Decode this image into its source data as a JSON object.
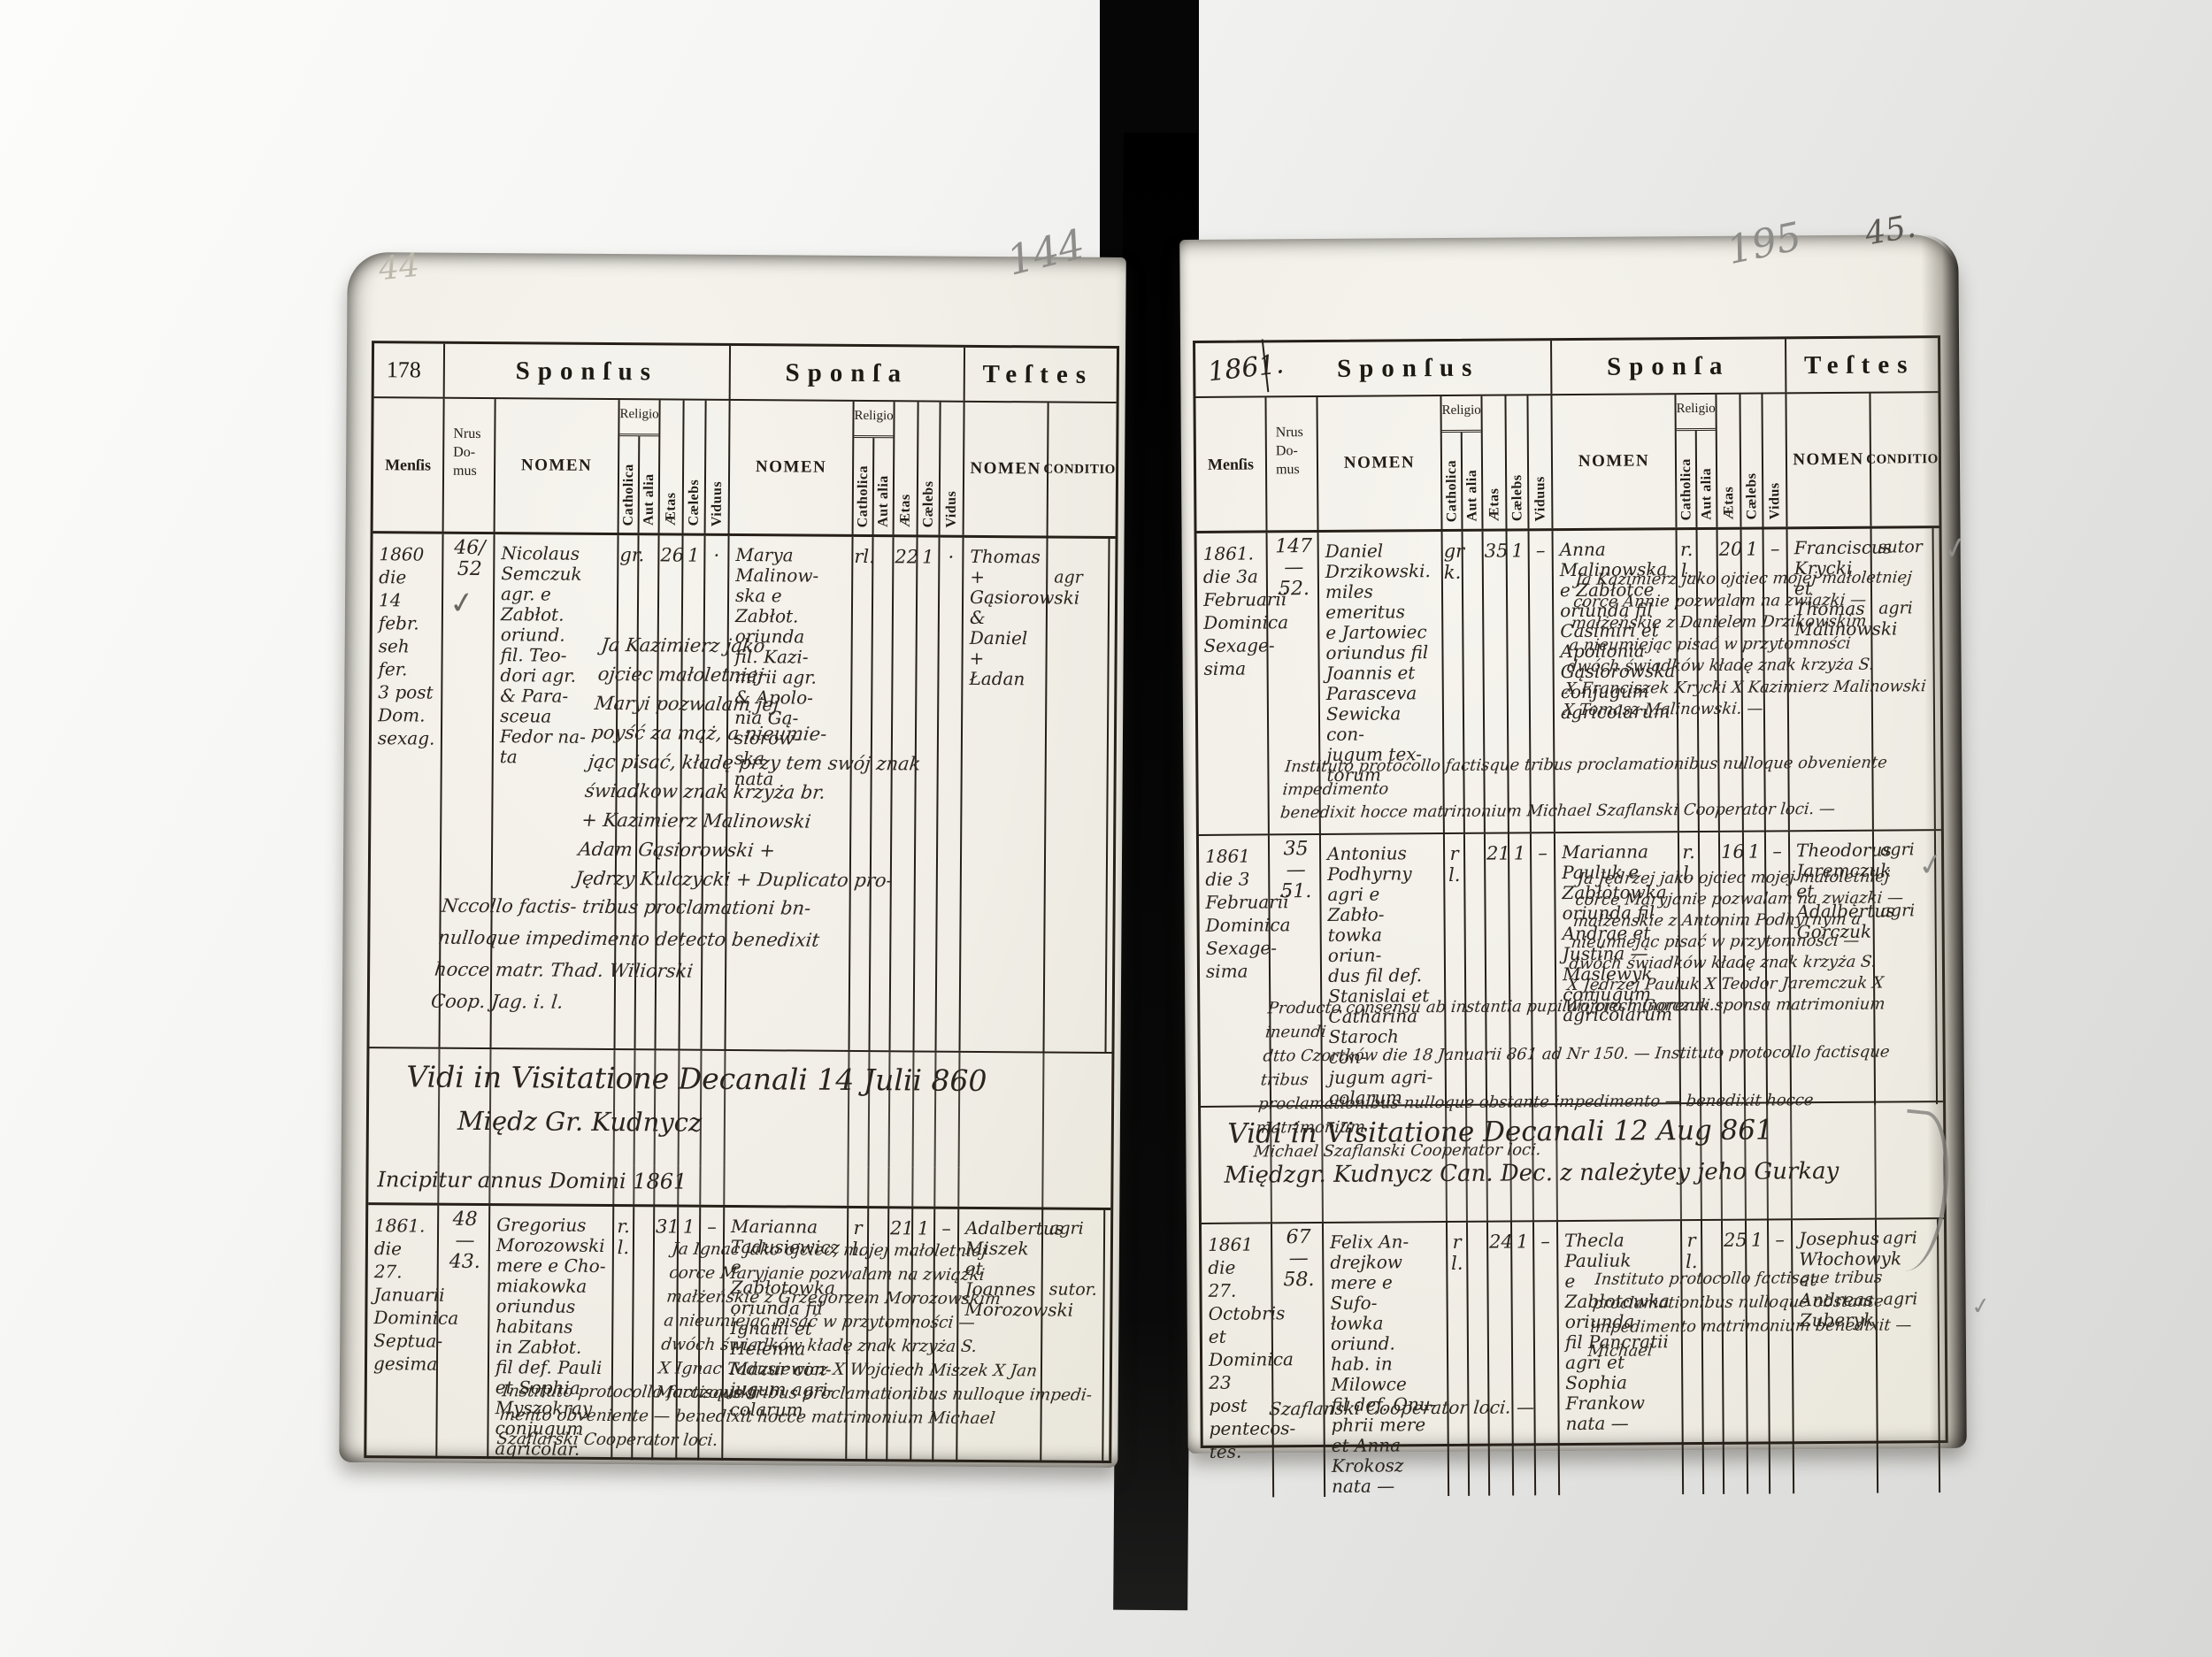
{
  "headers": {
    "sponsus": "Sponſus",
    "sponsa": "Sponſa",
    "testes": "Teſtes",
    "mensis": "Menſis",
    "nrus": "Nrus\nDo-\nmus",
    "nomen": "NOMEN",
    "religio": "Religio",
    "catholica": "Catholica",
    "aut_alia": "Aut alia",
    "aetas": "Ætas",
    "caelebs": "Cælebs",
    "viduus": "Viduus",
    "vidus": "Vidus",
    "conditio": "CONDITIO"
  },
  "marks": {
    "top_left_faint": "44",
    "left_page_pencil": "144",
    "right_page_pencil": "195",
    "right_page_ink": "45.",
    "check": "✓"
  },
  "left_page": {
    "page_number": "178",
    "visitation_line1": "Vidi in Visitatione Decanali 14 Julii 860",
    "visitation_line2": "Międz Gr. Kudnycz",
    "incipitur": "Incipitur annus Domini 1861",
    "entries": [
      {
        "mensis": "1860\ndie\n14 febr.\nseh fer.\n3 post\nDom.\nsexag.",
        "nrus": "46/\n52",
        "sp_nomen": "Nicolaus\nSemczuk\nagr. e\nZabłot.\noriund.\nfil. Teo-\ndori agr.\n& Para-\nsceua\nFedor na-\nta",
        "sp_rel": "gr.",
        "sp_aetas": "26",
        "sp_cael": "1",
        "sp_vid": "·",
        "sa_nomen": "Marya\nMalinow-\nska e\nZabłot.\noriunda\nfil. Kazi-\nmirii agr.\n& Apolo-\nnia Gą-\nsiorow-\nska\nnata",
        "sa_rel": "rl.",
        "sa_aetas": "22",
        "sa_cael": "1",
        "sa_vid": "·",
        "t_nomen": "Thomas +\nGąsiorowski\n&\nDaniel +\nŁadan",
        "t_cond": "\nagr",
        "note_pl": "Ja Kazimierz jako\nojciec małoletniej\nMaryi pozwalam jej\npoyść za mąż, a nieumie-\njąc pisać, kładę przy tem swój znak\nświadkow znak krzyża br.\n+ Kazimierz Malinowski\nAdam Gąsiorowski +\nJędrzy Kulczycki +      Duplicato pro-",
        "note_la": "Nccollo factis- tribus proclamationi bn-\nnulloque impedimento detecto benedixit\nhocce matr.      Thad. Wiliorski\nCoop. Jag. i. l."
      },
      {
        "mensis": "1861.\ndie 27.\nJanuarii\nDominica\nSeptua-\ngesima",
        "nrus": "48\n—\n43.",
        "sp_nomen": "Gregorius\nMorozowski\nmere e Cho-\nmiakowka\noriundus\nhabitans\nin Zabłot.\nfil def. Pauli\net Sophia\nMyszokray\nconjugum\nagricolar.",
        "sp_rel": "r. l.",
        "sp_aetas": "31",
        "sp_cael": "1",
        "sp_vid": "–",
        "sa_nomen": "Marianna\nTadusiewicz\ne Zabłotowka\noriunda fil\nIgnatii et\nHelenna\nMazur con-\njugum agri-\ncolarum",
        "sa_rel": "r l.",
        "sa_aetas": "21",
        "sa_cael": "1",
        "sa_vid": "–",
        "t_nomen": "Adalbertus\nMiszek\net\nJoannes\nMorozowski",
        "t_cond": "agri\n\n\nsutor.",
        "note_pl": "Ja Ignac jako ojciec, mojej małoletniej\ncorce Maryjanie pozwalam na związki\nmałżeńskie z Grzegorzem Morozowskim\na nieumiejąc pisać w przytomności —\ndwóch świadków kładę znak krzyża S.\nX Ignac Tadusiewicz X Wojciech Miszek X Jan Morozowski",
        "note_la": "Instituto protocollo factisque tribus proclamationibus nulloque impedi-\nmento obveniente — benedixit hocce matrimonium Michael\nSzaflarski Cooperator loci."
      }
    ]
  },
  "right_page": {
    "corner_year": "1861.",
    "visitation_line1": "Vidi in Visitatione Decanali 12 Aug 861",
    "visitation_line2": "Międzgr. Kudnycz Can. Dec. z należytey jeho Gurkay",
    "entries": [
      {
        "mensis": "1861.\ndie 3a\nFebruarii\nDominica\nSexage-\nsima",
        "nrus": "147\n—\n52.",
        "sp_nomen": "Daniel\nDrzikowski.\nmiles emeritus\ne Jartowiec\noriundus fil\nJoannis et\nParasceva\nSewicka con-\njugum tex-\ntorum",
        "sp_rel": "gr k.",
        "sp_aetas": "35",
        "sp_cael": "1",
        "sp_vid": "–",
        "sa_nomen": "Anna\nMalinowska\ne Zabłotce\noriunda fil\nCasimiri et\nApollonia\nGąsiorowska\nconjugum\nagricolarum",
        "sa_rel": "r. l.",
        "sa_aetas": "20",
        "sa_cael": "1",
        "sa_vid": "–",
        "t_nomen": "Franciscus\nKrycki\net\nThomas\nMalinowski",
        "t_cond": "sutor\n\n\nagri",
        "note_pl": "Ja Kazimierz jako ojciec mojej małoletniej\ncorce Annie pozwalam na związki —\nmałżeńskie z Danielem Drzikowskim\na nieumiejąc pisać w przytomności\ndwóch świadków kładę znak krzyża S.\nX Franciszek Krycki X Kazimierz Malinowski\nX Tomasz Malinowski. —",
        "note_la": "Instituto protocollo factisque tribus proclamationibus nulloque obveniente impedimento\nbenedixit hocce matrimonium      Michael Szaflanski Cooperator loci. —"
      },
      {
        "mensis": "1861\ndie 3\nFebruarii\nDominica\nSexage-\nsima",
        "nrus": "35\n—\n51.",
        "sp_nomen": "Antonius\nPodhyrny\nagri e Zabło-\ntowka oriun-\ndus fil def.\nStanislai et\nCatharina\nStaroch con-\njugum agri-\ncolarum",
        "sp_rel": "r l.",
        "sp_aetas": "21",
        "sp_cael": "1",
        "sp_vid": "–",
        "sa_nomen": "Marianna\nPauluk e\nZabłotowka\noriunda fil\nAndrae et\nJustina —\nMaslewyk\nconjugum\nagricolarum",
        "sa_rel": "r. l.",
        "sa_aetas": "16",
        "sa_cael": "1",
        "sa_vid": "–",
        "t_nomen": "Theodorus\nJaremczuk\net\nAdalbertus\nGorczuk",
        "t_cond": "agri\n\n\nagri",
        "note_pl": "Ja Jędrzej jako ojciec mojej małoletniej\ncorce Maryjanie pozwalam na związki —\nmałżeńskie z Antonim Podhyrnym a\nnieumiejąc pisać w przytomności —\ndwóch świadków kładę znak krzyża S.\nX Jędrzej Pauluk X Teodor Jaremczuk X Wojciech Gorczuk.",
        "note_la": "Producto consensu ab instantia pupilari pro minorenni sponsa matrimonium ineundi\ndtto Czortków die 18 Januarii 861 ad Nr 150. —      Instituto protocollo factisque tribus\nproclamationibus nulloque obstante impedimento — benedixit hocce matrimonium\nMichael Szaflanski Cooperator loci."
      },
      {
        "mensis": "1861\ndie 27.\nOctobris\net Dominica\n23 post\npentecos-\ntes.",
        "nrus": "67\n—\n58.",
        "sp_nomen": "Felix An-\ndrejkow\nmere e Sufo-\nłowka oriund.\nhab. in Milowce\nfil def. Onu-\nphrii mere\net Anna\nKrokosz\nnata —",
        "sp_rel": "r l.",
        "sp_aetas": "24",
        "sp_cael": "1",
        "sp_vid": "–",
        "sa_nomen": "Thecla\nPauliuk\ne Zabłotowka\noriunda\nfil Pancratii\nagri et\nSophia\nFrankow\nnata —",
        "sa_rel": "r l.",
        "sa_aetas": "25",
        "sa_cael": "1",
        "sa_vid": "–",
        "t_nomen": "Josephus\nWłochowyk\net\nAndreas\nZuberyk",
        "t_cond": "agri\n\n\nagri",
        "note_la": "Instituto protocollo factisque tribus\nproclamationibus nulloque obstante\nimpedimento matrimonium benedixit — Michael",
        "note_la2": "Szaflanski Cooperator loci. —"
      }
    ]
  }
}
